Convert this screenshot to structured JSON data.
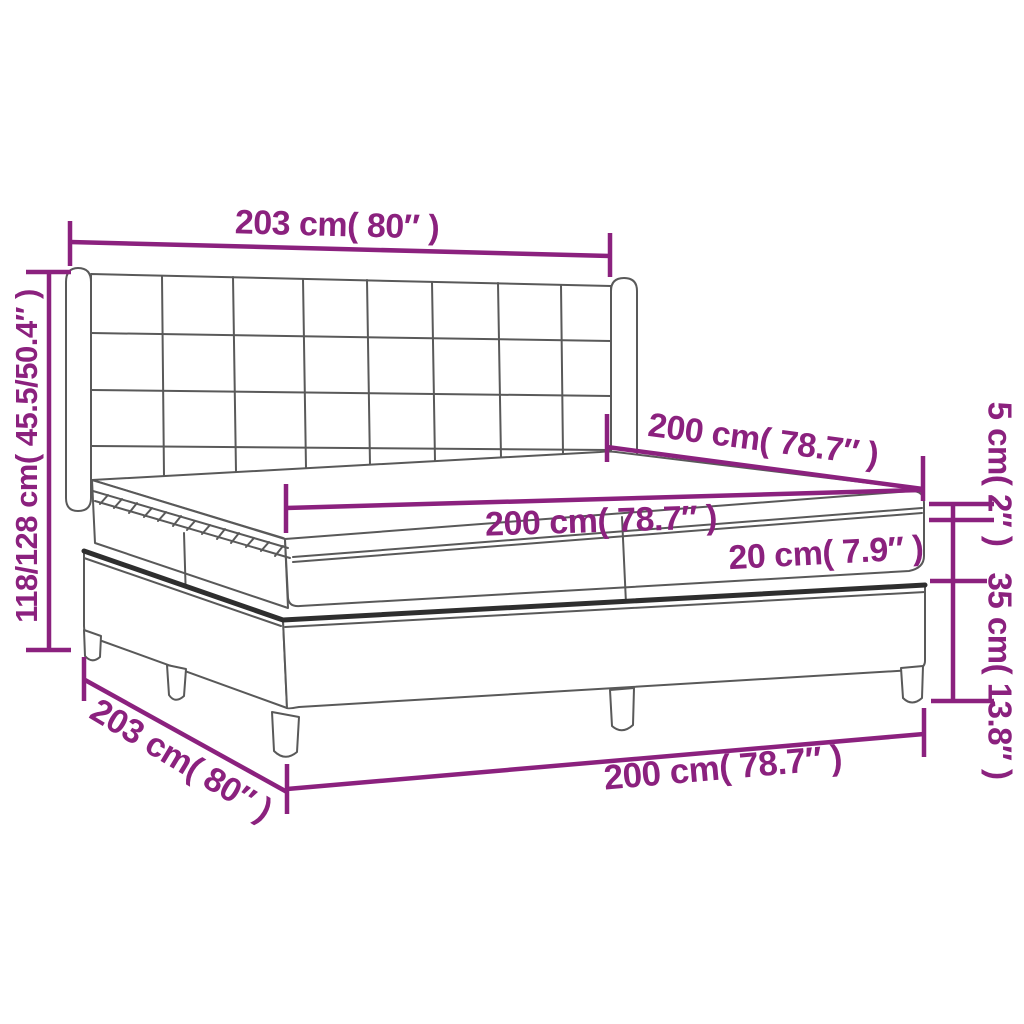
{
  "diagram": {
    "title": "box-spring-bed-dimension-diagram",
    "labels": {
      "headboard_width": "203 cm( 80″ )",
      "total_height": "118/128 cm( 45.5/50.4″ )",
      "mattress_length": "200 cm( 78.7″ )",
      "mattress_width": "200 cm( 78.7″ )",
      "mattress_thickness": "20 cm( 7.9″ )",
      "topper_thickness": "5 cm( 2″ )",
      "base_height": "35 cm( 13.8″ )",
      "frame_depth": "203 cm( 80″ )",
      "frame_width": "200 cm( 78.7″ )"
    },
    "colors": {
      "dimension": "#8B217E",
      "line": "#595959",
      "line_dark": "#2E2E2E",
      "background": "#FFFFFF"
    }
  }
}
